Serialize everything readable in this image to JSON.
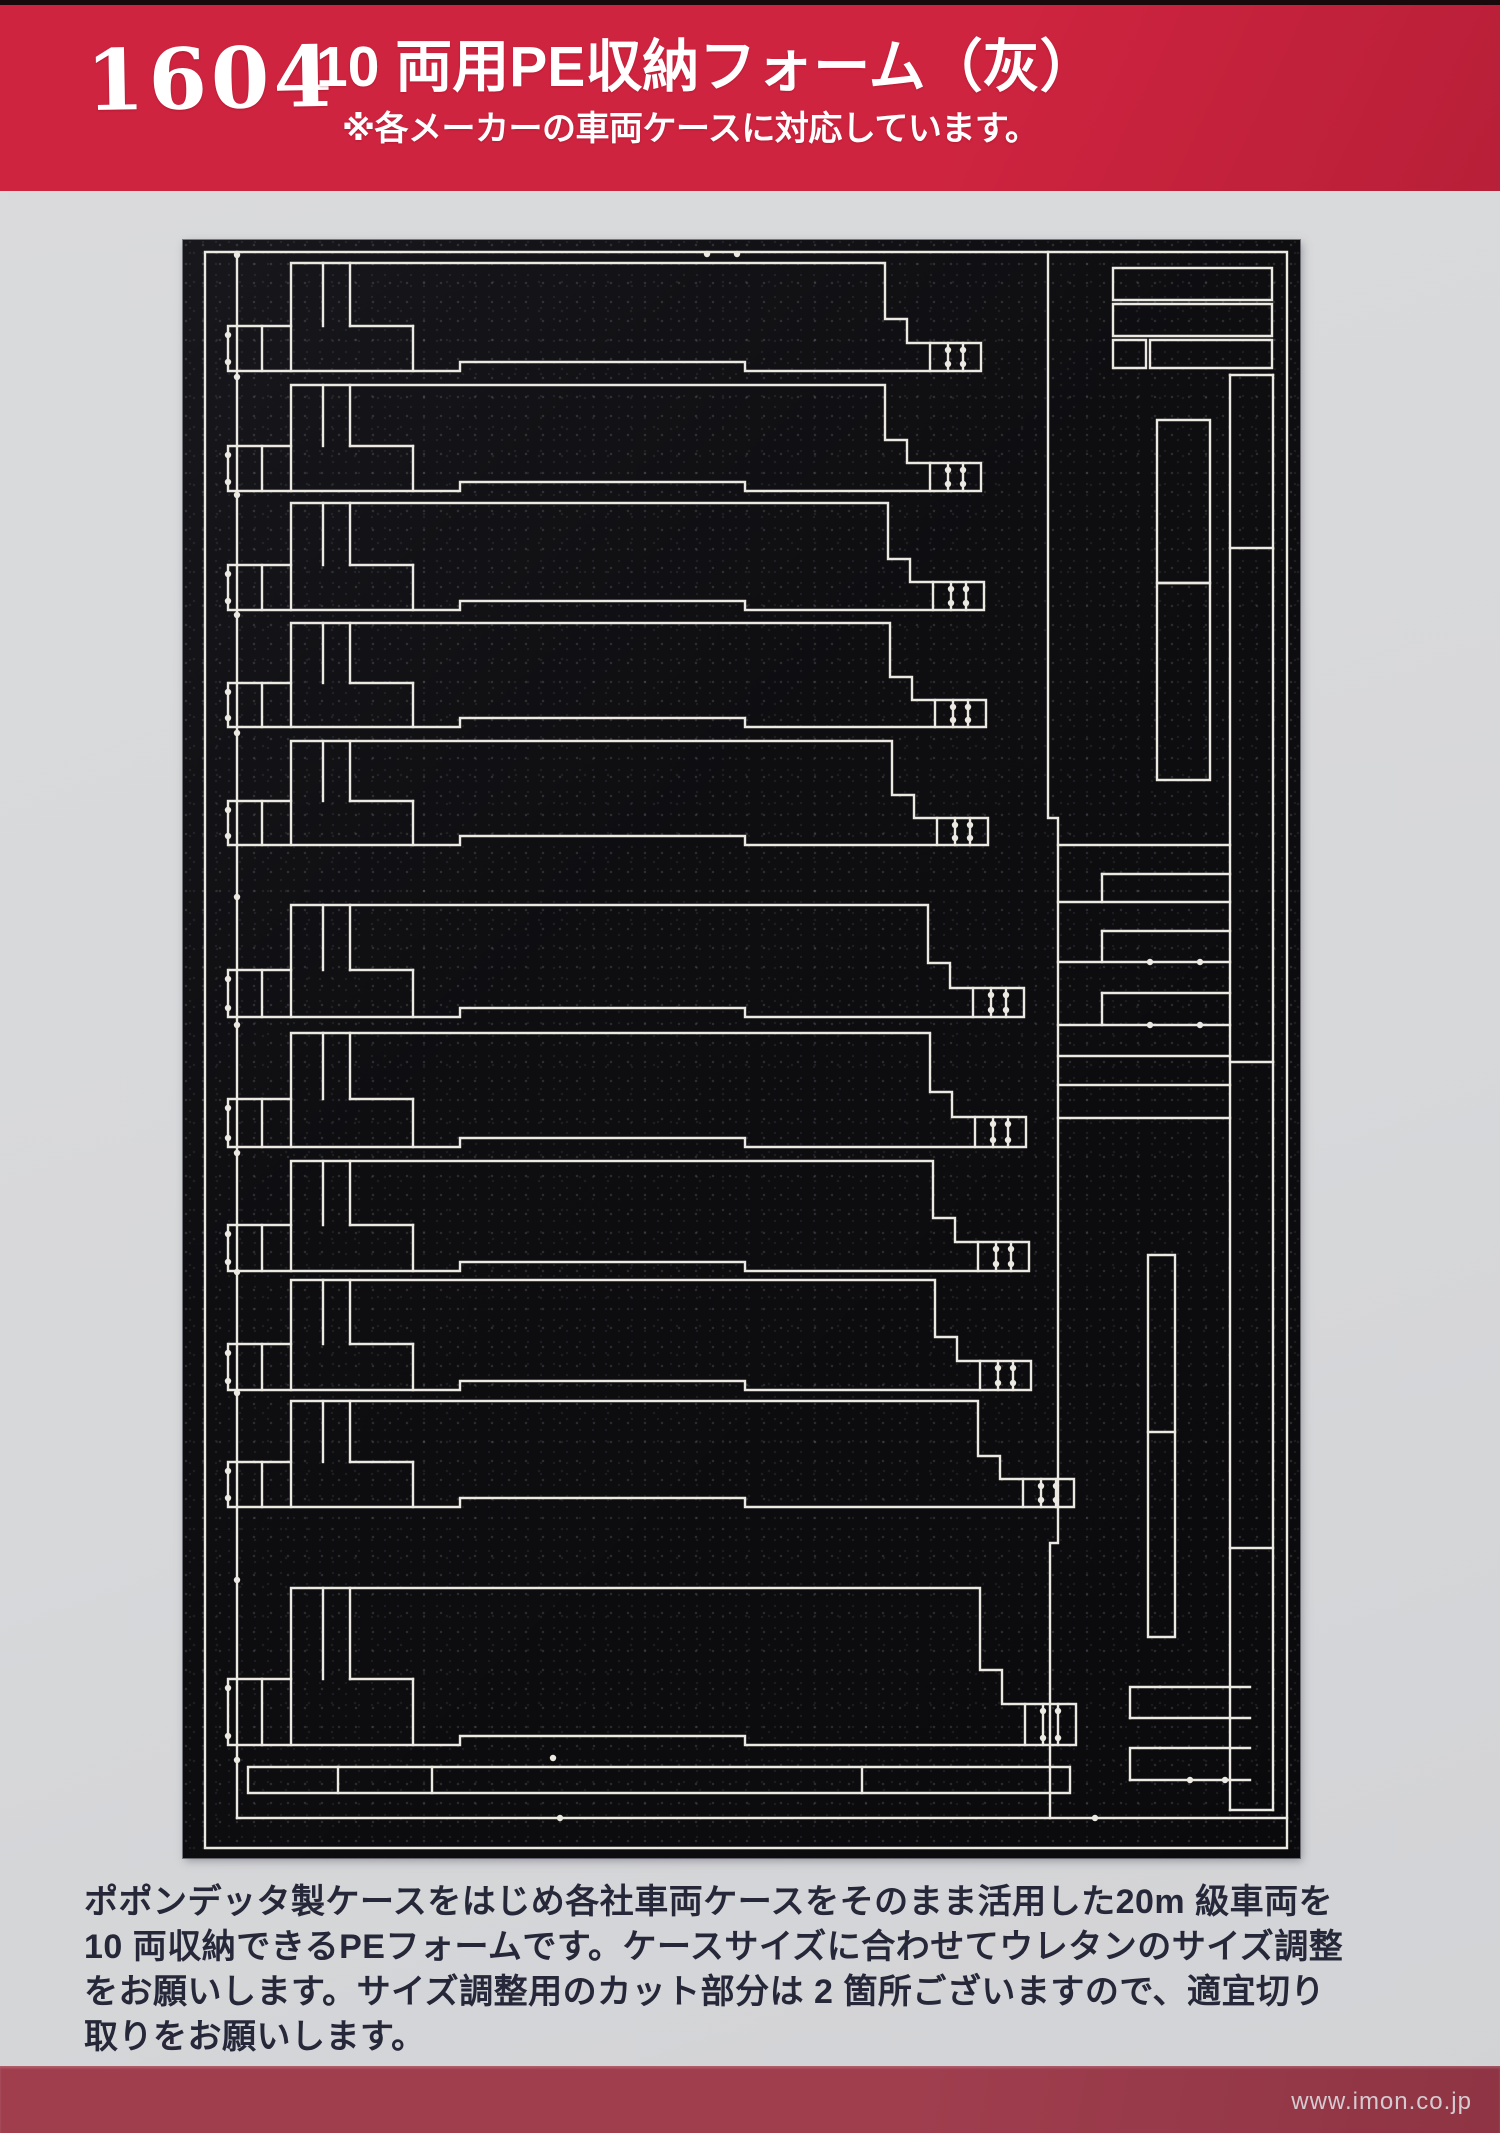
{
  "colors": {
    "red_band": "#cf2440",
    "red_band_dark": "#b81f38",
    "bottom_band": "#a03e4e",
    "bottom_band_dark": "#8e3443",
    "page_bg": "#d7d8da",
    "foam_black": "#0e0e11",
    "cut_line": "#ece9e2",
    "text_dark": "#262839",
    "header_text": "#ffffff",
    "watermark_color": "#d4cbd0"
  },
  "header": {
    "product_number": "1604",
    "title": "10 両用PE収納フォーム（灰）",
    "subtitle": "※各メーカーの車両ケースに対応しています。"
  },
  "description": {
    "lines": [
      "ポポンデッタ製ケースをはじめ各社車両ケースをそのまま活用した20m 級車両を",
      "10 両収納できるPEフォームです。ケースサイズに合わせてウレタンのサイズ調整",
      "をお願いします。サイズ調整用のカット部分は 2 箇所ございますので、適宜切り",
      "取りをお願いします。"
    ]
  },
  "watermark": "www.imon.co.jp",
  "diagram": {
    "label": "PE foam die-cut layout photo: stacked car slots with stepped ends, right-hand spacer pieces, bottom adjustment strip",
    "view": [
      183,
      240,
      1117,
      1618
    ],
    "rows": [
      {
        "t": 263,
        "h": 108,
        "e": 885
      },
      {
        "t": 385,
        "h": 106,
        "e": 885
      },
      {
        "t": 503,
        "h": 107,
        "e": 888
      },
      {
        "t": 623,
        "h": 104,
        "e": 890
      },
      {
        "t": 741,
        "h": 104,
        "e": 892
      },
      {
        "t": 905,
        "h": 112,
        "e": 928
      },
      {
        "t": 1033,
        "h": 114,
        "e": 930
      },
      {
        "t": 1161,
        "h": 110,
        "e": 933
      },
      {
        "t": 1280,
        "h": 110,
        "e": 935
      },
      {
        "t": 1401,
        "h": 106,
        "e": 978
      },
      {
        "t": 1588,
        "h": 157,
        "e": 980
      }
    ],
    "paths": [
      "M 205 252 H 1287 V 1848 H 205 Z",
      "M 237 252 V 1818",
      "M 237 1818 H 1287",
      "M 1048 252 V 818 H 1058 V 1543 H 1050 V 1818",
      "M 1113 268 H 1272 V 300 H 1113 Z",
      "M 1113 304 H 1272 V 336 H 1113 Z",
      "M 1150 340 H 1272 V 368 H 1150 Z",
      "M 1113 340 H 1146 V 368 H 1113 Z",
      "M 1230 375 V 1810",
      "M 1273 375 V 1810",
      "M 1230 375 H 1273",
      "M 1230 548 H 1273",
      "M 1230 1062 H 1273",
      "M 1230 1548 H 1273",
      "M 1230 1810 H 1273",
      "M 1157 420 H 1210 V 583 H 1157 Z",
      "M 1157 583 H 1210 V 780 H 1157 Z",
      "M 1148 1255 H 1175 V 1637 H 1148 Z",
      "M 1148 1432 H 1175",
      "M 1058 845 H 1230",
      "M 1102 874 H 1230",
      "M 1102 874 V 902",
      "M 1058 902 H 1230",
      "M 1102 931 H 1230",
      "M 1102 931 V 962",
      "M 1058 962 H 1230",
      "M 1102 993 H 1230",
      "M 1102 993 V 1025",
      "M 1058 1025 H 1230",
      "M 1058 1056 H 1230",
      "M 1058 1085 H 1230",
      "M 1058 1118 H 1230",
      "M 1160 1687 H 1250",
      "M 1130 1718 H 1250",
      "M 1130 1718 V 1687 H 1160",
      "M 1160 1748 H 1250",
      "M 1130 1780 H 1250",
      "M 1130 1780 V 1748 H 1160",
      "M 248 1767 H 1070 V 1793 H 248 Z",
      "M 338 1767 V 1793",
      "M 432 1767 V 1793",
      "M 862 1767 V 1793"
    ],
    "dots": [
      [
        707,
        254
      ],
      [
        737,
        254
      ],
      [
        560,
        1818
      ],
      [
        1095,
        1818
      ],
      [
        553,
        1758
      ],
      [
        237,
        1760
      ],
      [
        1150,
        962
      ],
      [
        1200,
        962
      ],
      [
        1150,
        1025
      ],
      [
        1200,
        1025
      ],
      [
        1190,
        1780
      ],
      [
        1225,
        1780
      ]
    ]
  }
}
